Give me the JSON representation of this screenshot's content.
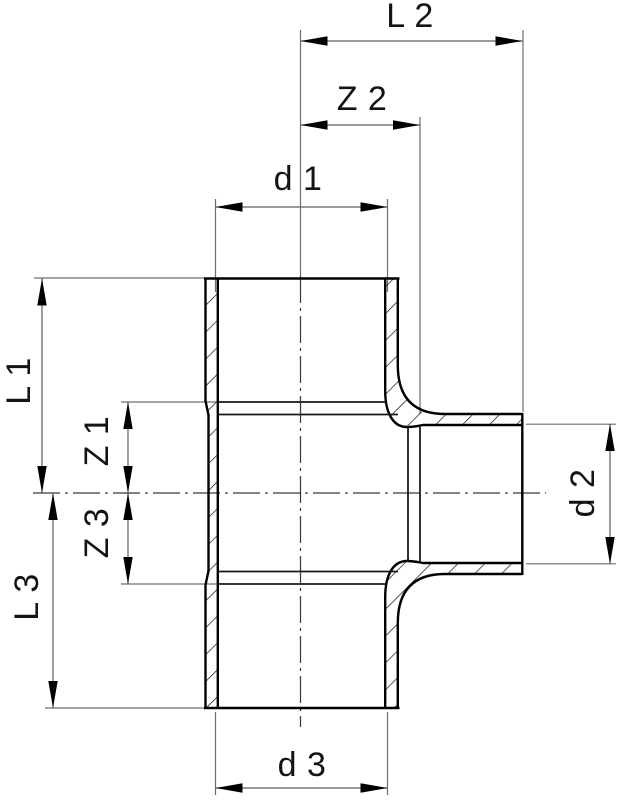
{
  "drawing": {
    "type": "engineering dimension drawing",
    "subject": "Cross-section of a reducing tee pipe fitting with three socket outlets (top, bottom, right branch)",
    "background_color": "#ffffff",
    "outline_color": "#000000",
    "thin_line_color": "#6f6f6f",
    "hatch_style": "45-degree section hatching in cut walls",
    "labels": {
      "l2": "L 2",
      "z2": "Z 2",
      "d1": "d 1",
      "l1": "L 1",
      "z1": "Z 1",
      "z3": "Z 3",
      "l3": "L 3",
      "d2": "d 2",
      "d3": "d 3"
    },
    "dimensions": [
      {
        "id": "L2",
        "label": "L 2",
        "orientation": "horizontal",
        "position": "top"
      },
      {
        "id": "Z2",
        "label": "Z 2",
        "orientation": "horizontal",
        "position": "top"
      },
      {
        "id": "d1",
        "label": "d 1",
        "orientation": "horizontal",
        "position": "across top socket opening"
      },
      {
        "id": "L1",
        "label": "L 1",
        "orientation": "vertical",
        "position": "far left, top half"
      },
      {
        "id": "Z1",
        "label": "Z 1",
        "orientation": "vertical",
        "position": "left, above centerline"
      },
      {
        "id": "Z3",
        "label": "Z 3",
        "orientation": "vertical",
        "position": "left, below centerline"
      },
      {
        "id": "L3",
        "label": "L 3",
        "orientation": "vertical",
        "position": "far left, bottom half"
      },
      {
        "id": "d2",
        "label": "d 2",
        "orientation": "vertical",
        "position": "right, across branch outlet"
      },
      {
        "id": "d3",
        "label": "d 3",
        "orientation": "horizontal",
        "position": "across bottom socket opening"
      }
    ]
  }
}
